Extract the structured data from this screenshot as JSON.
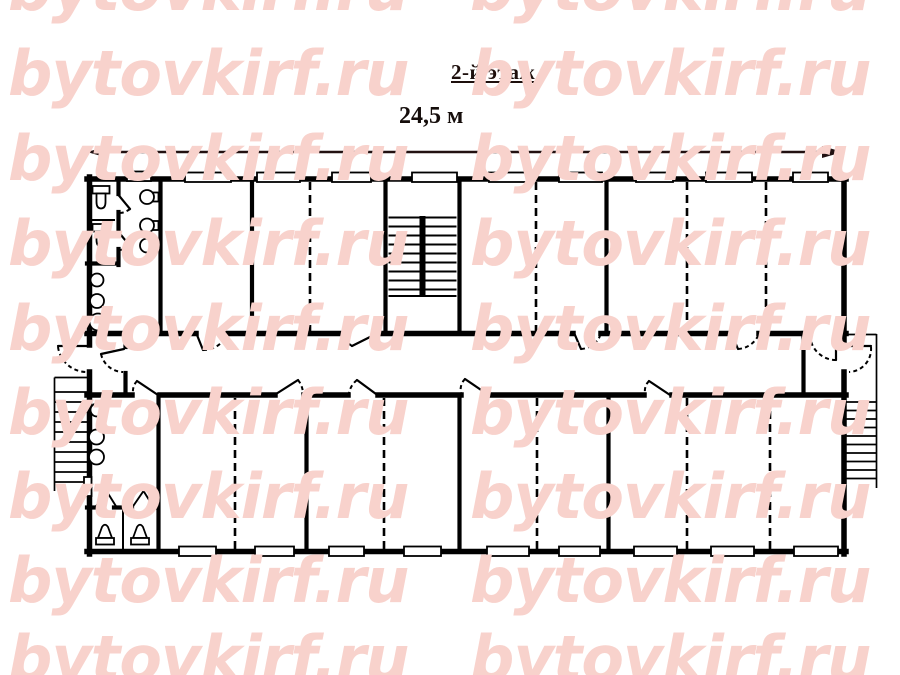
{
  "title": {
    "text": "2-й этаж"
  },
  "dimension": {
    "label": "24,5 м",
    "value": "24,5",
    "unit": "м"
  },
  "watermark": {
    "text": "bytovkirf.ru",
    "color": "#f8d2cc"
  },
  "colors": {
    "background": "#ffffff",
    "plan_lines": "#000000",
    "annotation_text": "#1d0f0c",
    "watermark_pink": "#f8d2cc"
  }
}
